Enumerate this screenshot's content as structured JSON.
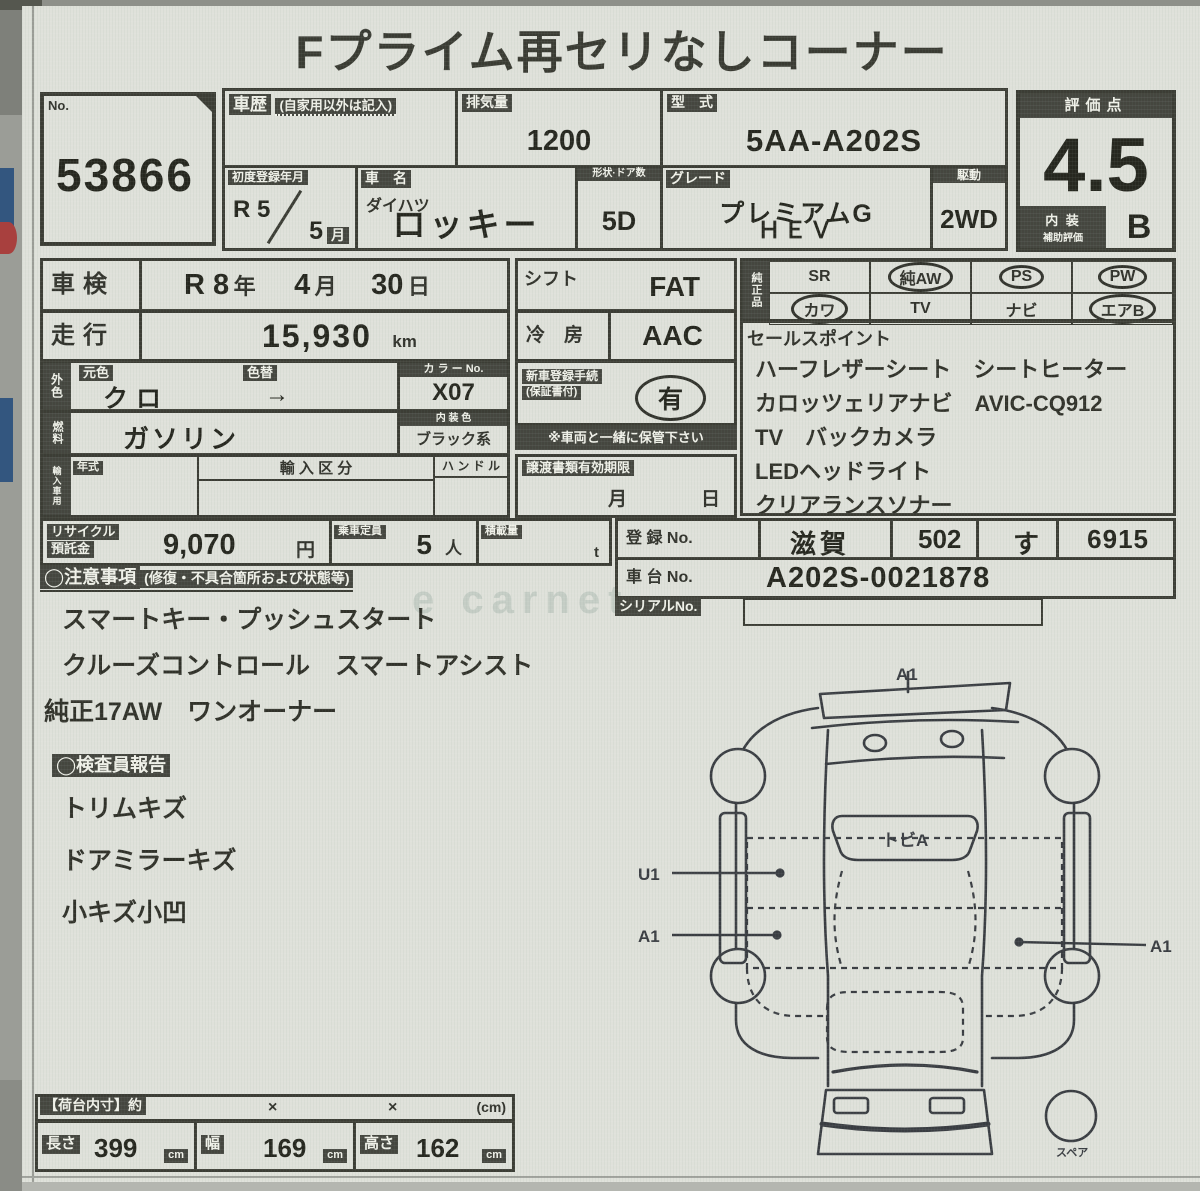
{
  "photo": {
    "watermark": "e carnet"
  },
  "title": "Fプライム再セリなしコーナー",
  "lot": {
    "label": "No.",
    "value": "53866"
  },
  "history": {
    "label": "車歴",
    "note": "(自家用以外は記入)"
  },
  "displacement": {
    "label": "排気量",
    "value": "1200"
  },
  "model_code": {
    "label": "型　式",
    "value": "5AA-A202S"
  },
  "first_reg": {
    "label": "初度登録年月",
    "era": "R 5",
    "month": "5",
    "month_unit": "月"
  },
  "car": {
    "label": "車　名",
    "maker": "ダイハツ",
    "model": "ロッキー"
  },
  "body_doors": {
    "label": "形状·ドア数",
    "value": "5D"
  },
  "grade": {
    "label": "グレード",
    "line1": "プレミアムG",
    "line2": "ＨＥＶ"
  },
  "drive": {
    "label": "駆動",
    "value": "2WD"
  },
  "score": {
    "label": "評価点",
    "value": "4.5",
    "interior_label_1": "内 装",
    "interior_label_2": "補助評価",
    "interior_value": "B"
  },
  "shaken": {
    "label": "車検",
    "v1": "R 8",
    "u1": "年",
    "v2": "4",
    "u2": "月",
    "v3": "30",
    "u3": "日"
  },
  "mileage": {
    "label": "走行",
    "value": "15,930",
    "unit": "km"
  },
  "shift": {
    "label": "シフト",
    "value": "FAT"
  },
  "aircon": {
    "label": "冷　房",
    "value": "AAC"
  },
  "genuine": {
    "label": "純正品",
    "items": [
      {
        "label": "SR",
        "circled": false
      },
      {
        "label": "純AW",
        "circled": true
      },
      {
        "label": "PS",
        "circled": true
      },
      {
        "label": "PW",
        "circled": true
      },
      {
        "label": "カワ",
        "circled": true
      },
      {
        "label": "TV",
        "circled": false
      },
      {
        "label": "ナビ",
        "circled": false
      },
      {
        "label": "エアB",
        "circled": true
      }
    ]
  },
  "sales_points": {
    "label": "セールスポイント",
    "lines": [
      "ハーフレザーシート　シートヒーター",
      "カロッツェリアナビ　AVIC-CQ912",
      "TV　バックカメラ",
      "LEDヘッドライト",
      "クリアランスソナー"
    ]
  },
  "ext_color": {
    "label": "外色",
    "orig_label": "元色",
    "orig_value": "クロ",
    "repaint_label": "色替",
    "repaint_value": "→",
    "color_no_label": "カ ラ ー No.",
    "color_no_value": "X07"
  },
  "fuel": {
    "label": "燃料",
    "value": "ガソリン",
    "interior_color_label": "内 装 色",
    "interior_color_value": "ブラック系"
  },
  "import_row": {
    "label": "輸入車用",
    "year_label": "年式",
    "class_label": "輸 入 区 分",
    "handle_label": "ハ ン ド ル"
  },
  "new_car_docs": {
    "label1": "新車登録手続",
    "label2": "(保証書付)",
    "value": "有",
    "note": "※車両と一緒に保管下さい"
  },
  "transfer_docs": {
    "label": "譲渡書類有効期限",
    "month_unit": "月",
    "day_unit": "日"
  },
  "recycle": {
    "label1": "リサイクル",
    "label2": "預託金",
    "value": "9,070",
    "unit": "円"
  },
  "seating": {
    "label": "乗車定員",
    "value": "5",
    "unit": "人"
  },
  "payload": {
    "label": "積載量",
    "unit": "t"
  },
  "registration": {
    "label": "登 録 No.",
    "area": "滋賀",
    "class_no": "502",
    "kana": "す",
    "number": "6915"
  },
  "chassis": {
    "label": "車 台 No.",
    "value": "A202S-0021878"
  },
  "serial": {
    "label": "シリアルNo."
  },
  "cautions": {
    "header": "◯注意事項",
    "header_note": "(修復・不具合箇所および状態等)",
    "lines": [
      "スマートキー・プッシュスタート",
      "クルーズコントロール　スマートアシスト",
      "純正17AW　ワンオーナー"
    ]
  },
  "inspector_report": {
    "header": "◯検査員報告",
    "lines": [
      "トリムキズ",
      "ドアミラーキズ",
      "小キズ小凹"
    ]
  },
  "diagram": {
    "rear_label": "A1",
    "glass_label": "トビA",
    "left_label_1": "U1",
    "left_label_2": "A1",
    "right_label": "A1",
    "spare_label": "スペア"
  },
  "cargo_dims": {
    "header": "【荷台内寸】約",
    "x1": "×",
    "x2": "×",
    "unit_note": "(cm)",
    "length_label": "長さ",
    "length_value": "399",
    "length_unit": "cm",
    "width_label": "幅",
    "width_value": "169",
    "width_unit": "cm",
    "height_label": "高さ",
    "height_value": "162",
    "height_unit": "cm"
  }
}
